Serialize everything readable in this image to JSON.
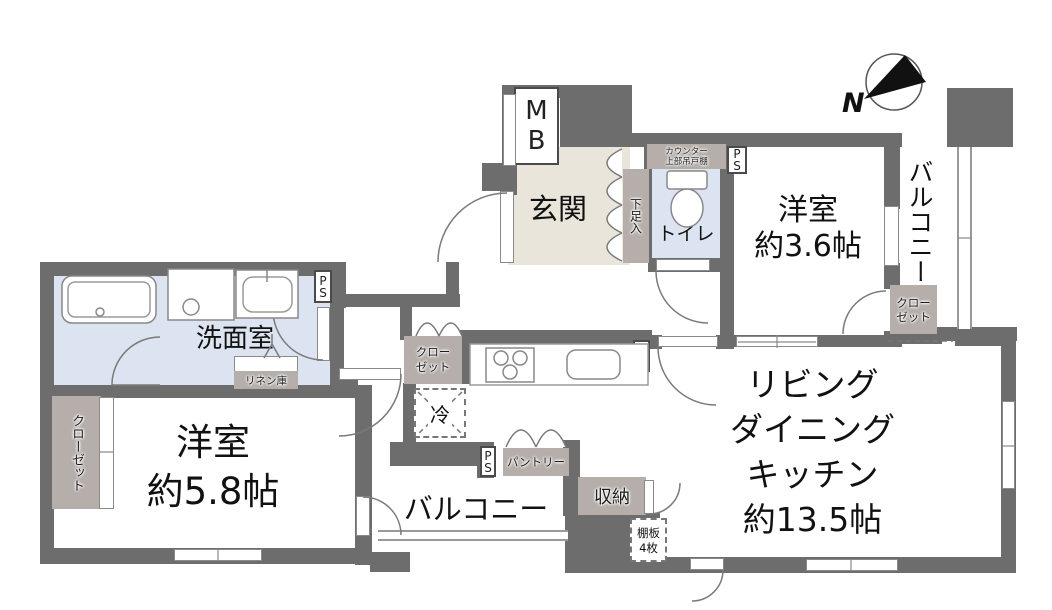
{
  "compass": {
    "north_label": "N"
  },
  "rooms": {
    "entrance": {
      "name": "玄関"
    },
    "toilet": {
      "name": "トイレ"
    },
    "western_small": {
      "name": "洋室",
      "size": "約3.6帖"
    },
    "western_main": {
      "name": "洋室",
      "size": "約5.8帖"
    },
    "washroom": {
      "name": "洗面室"
    },
    "ldk": {
      "name_line1": "リビング",
      "name_line2": "ダイニング",
      "name_line3": "キッチン",
      "size": "約13.5帖"
    },
    "balcony_right": {
      "name": "バルコニー"
    },
    "balcony_bottom": {
      "name": "バルコニー"
    }
  },
  "features": {
    "meter_box": "MB",
    "pipe_space": "PS",
    "shoe_cabinet": "下足入",
    "counter_shelf": {
      "line1": "カウンター",
      "line2": "上部吊戸棚"
    },
    "closet_right": {
      "line1": "クロー",
      "line2": "ゼット"
    },
    "closet_center": {
      "line1": "クロー",
      "line2": "ゼット"
    },
    "closet_left": "クローゼット",
    "linen_storage": "リネン庫",
    "refrigerator": "冷",
    "pantry": "パントリー",
    "storage": "収納",
    "shelf_note": {
      "line1": "棚板",
      "line2": "4枚"
    }
  },
  "colors": {
    "wall": "#6d6d6d",
    "wet_floor": "#dde4f1",
    "entrance_floor": "#eae5da",
    "storage_fill": "#b6aeaa",
    "line": "#777777"
  }
}
